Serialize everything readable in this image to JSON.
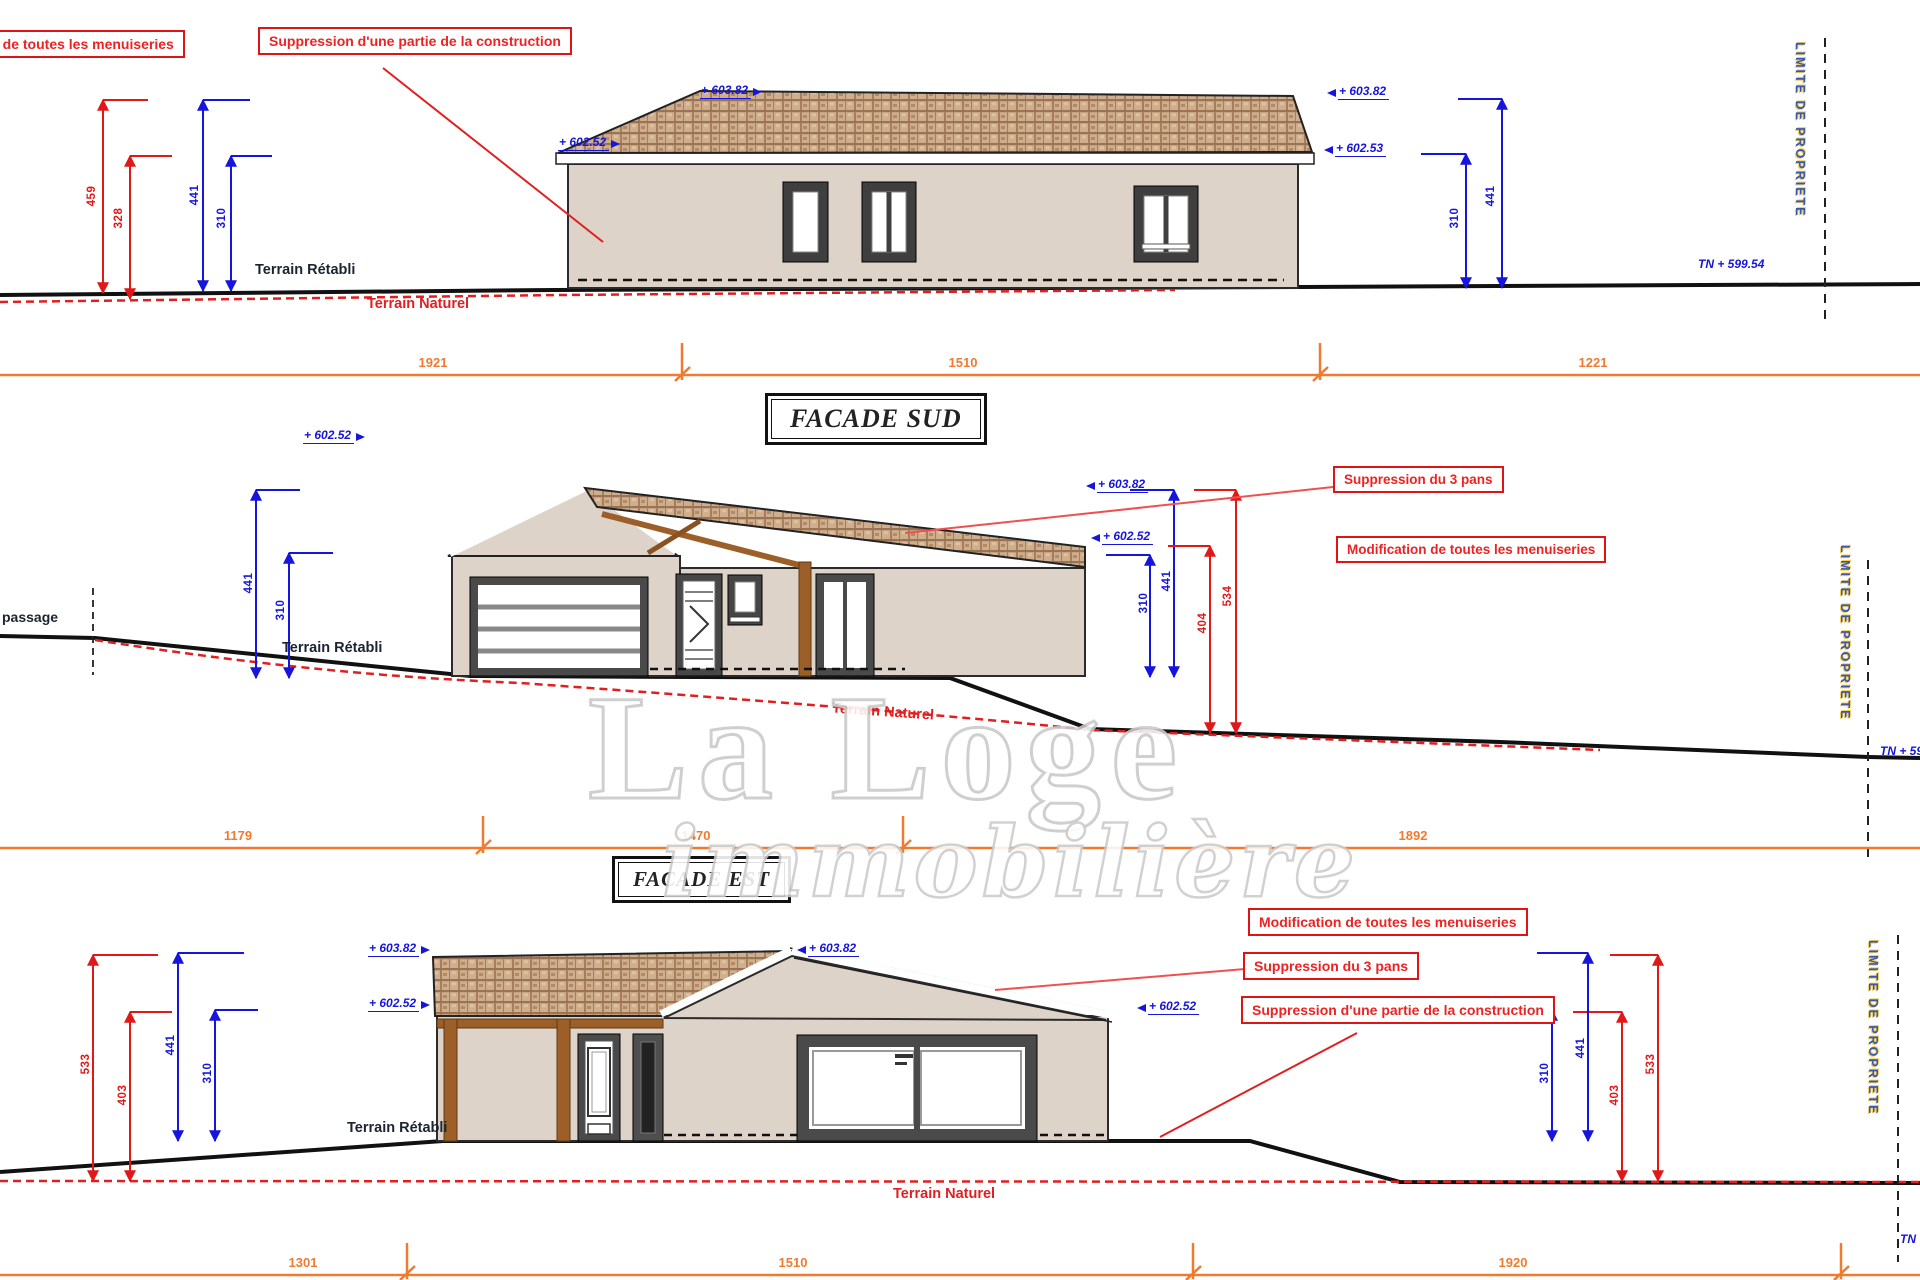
{
  "watermark": {
    "line1": "La Loge",
    "line2": "immobilière"
  },
  "sections": {
    "sud": {
      "title": "FACADE SUD",
      "boxes": {
        "menuiseries": "fication de toutes les menuiseries",
        "suppression_partie": "Suppression d'une partie de la construction"
      },
      "dims": {
        "red_459": "459",
        "red_328": "328",
        "left_441": "441",
        "left_310": "310",
        "right_441": "441",
        "right_310": "310"
      },
      "elevations": {
        "eave_left": "+ 602.52",
        "ridge_left": "+ 603.82",
        "ridge_right": "+ 603.82",
        "eave_right": "+ 602.53"
      },
      "terrain": {
        "retabli": "Terrain Rétabli",
        "naturel": "Terrain Naturel"
      },
      "property_line": "LIMITE DE PROPRIETE",
      "tn_level": "TN + 599.54",
      "orange_dims": [
        "1921",
        "1510",
        "1221"
      ]
    },
    "est": {
      "title": "FACADE EST",
      "passage": "passage",
      "boxes": {
        "suppression_3pans": "Suppression du 3 pans",
        "modification": "Modification de toutes les menuiseries"
      },
      "dims": {
        "left_441": "441",
        "left_310": "310",
        "right_310": "310",
        "right_441": "441",
        "red_404": "404",
        "red_534": "534"
      },
      "elevations": {
        "eave_left": "+ 602.52",
        "ridge_right": "+ 603.82",
        "eave_right": "+ 602.52"
      },
      "terrain": {
        "retabli": "Terrain Rétabli",
        "naturel": "Terrain Naturel"
      },
      "property_line": "LIMITE DE PROPRIETE",
      "tn_level": "TN + 59",
      "orange_dims": [
        "1179",
        "1470",
        "1892"
      ]
    },
    "third": {
      "boxes": {
        "modification": "Modification de toutes les menuiseries",
        "suppression_3pans": "Suppression du 3 pans",
        "suppression_partie": "Suppression d'une partie de la construction"
      },
      "dims": {
        "red_533_l": "533",
        "red_403_l": "403",
        "blue_441_l": "441",
        "blue_310_l": "310",
        "blue_310_r": "310",
        "blue_441_r": "441",
        "red_403_r": "403",
        "red_533_r": "533"
      },
      "elevations": {
        "ridge_left": "+ 603.82",
        "eave_left": "+ 602.52",
        "ridge_right": "+ 603.82",
        "eave_right": "+ 602.52"
      },
      "terrain": {
        "retabli": "Terrain Rétabli",
        "naturel": "Terrain Naturel"
      },
      "property_line": "LIMITE DE PROPRIETE",
      "tn_level": "TN +",
      "orange_dims": [
        "1301",
        "1510",
        "1920"
      ]
    }
  }
}
